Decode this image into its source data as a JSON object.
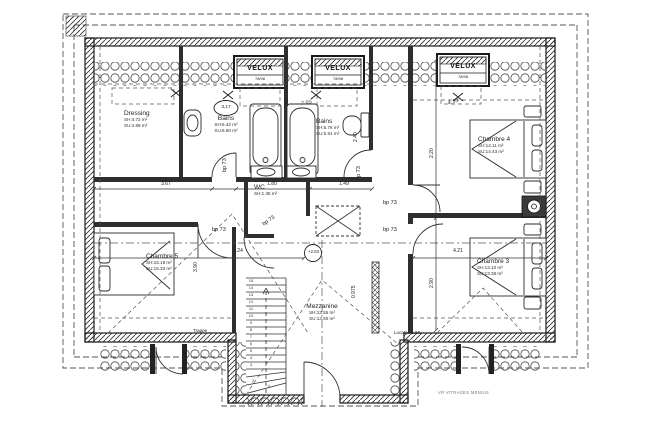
{
  "plan": {
    "rooms": [
      {
        "name": "Dressing",
        "sh": "SH:4.72 m²",
        "su": "SU:4.89 m²"
      },
      {
        "name": "Bains",
        "sh": "SH:6.42 m²",
        "su": "SU:6.80 m²"
      },
      {
        "name": "Bains",
        "sh": "SH:5.76 m²",
        "su": "SU:5.91 m²"
      },
      {
        "name": "Chambre 4",
        "sh": "SH:14.11 m²",
        "su": "SU:14.43 m²"
      },
      {
        "name": "Chambre 3",
        "sh": "SH:13.10 m²",
        "su": "SU:13.38 m²"
      },
      {
        "name": "Chambre 5",
        "sh": "SH:15.18 m²",
        "su": "SU:15.33 m²"
      },
      {
        "name": "WC",
        "sh": "SH:1.35 m²"
      },
      {
        "name": "Mezzanine",
        "sh": "SH:13.55 m²",
        "su": "SU:13.60 m²"
      }
    ],
    "labels": {
      "velux": "VELUX",
      "velux_size": "78/98",
      "door": "bp 73",
      "trappe": "Trappe",
      "lucarne": "Lucarne 1.50",
      "level": "+2.03",
      "footer": "VR VITRAGES MENUIS",
      "mark_circle": "3,17",
      "mark_bains": "2.05",
      "mark_chambre": "4.53"
    },
    "dimensions": {
      "w_dressing": "3.67",
      "w_bains": "1.80",
      "w_bains2": "1.49",
      "w_hall": "3.24",
      "w_chambre3": "4.21",
      "h_chambre3": "2.90",
      "h_chambre4": "2.20",
      "h_bains": "2.40",
      "h_mezz": "0.975",
      "h_chambre5": "3.90"
    },
    "stairs": [
      "15",
      "14",
      "13",
      "12",
      "11",
      "10",
      "9",
      "8",
      "7",
      "6",
      "5",
      "4",
      "3",
      "2",
      "1"
    ]
  }
}
